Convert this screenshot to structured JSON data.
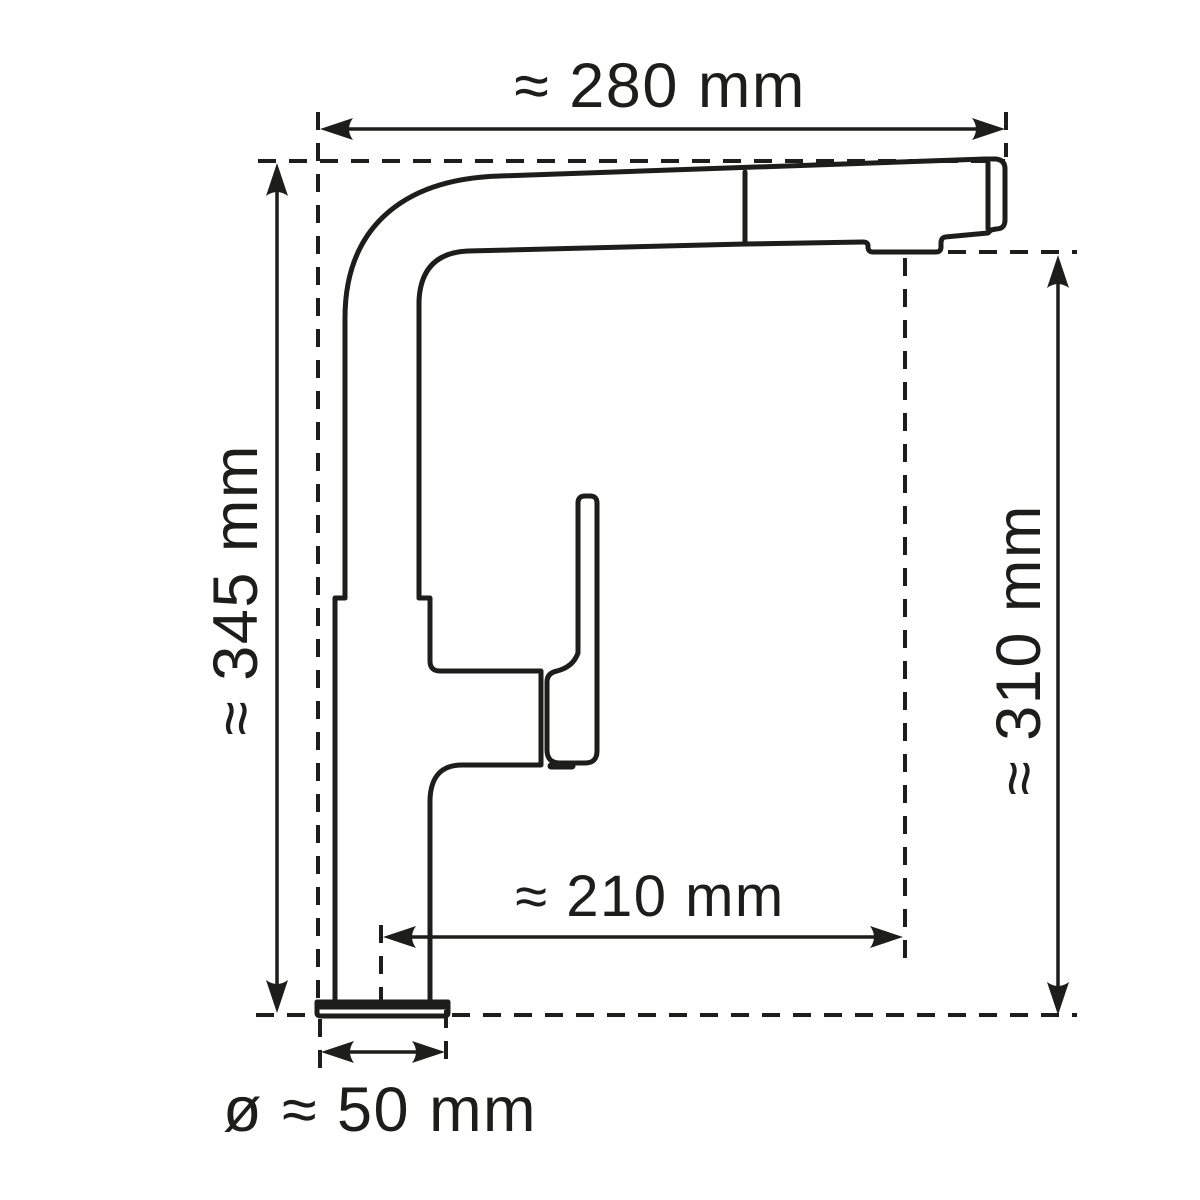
{
  "diagram": {
    "subject": "Kitchen mixer tap with pull-out spray head, side view technical line drawing with dimension annotations",
    "units": "mm",
    "style": {
      "line_color": "#1d1d1b",
      "background_color": "#ffffff"
    },
    "dimensions": {
      "overall_width": {
        "label": "≈ 280 mm",
        "value_mm": 280,
        "approximate": true,
        "orientation": "horizontal",
        "position": "top"
      },
      "overall_height": {
        "label": "≈ 345 mm",
        "value_mm": 345,
        "approximate": true,
        "orientation": "vertical",
        "position": "left"
      },
      "spout_height": {
        "label": "≈ 310 mm",
        "value_mm": 310,
        "approximate": true,
        "orientation": "vertical",
        "position": "right"
      },
      "spout_reach": {
        "label": "≈ 210 mm",
        "value_mm": 210,
        "approximate": true,
        "orientation": "horizontal",
        "position": "bottom-middle"
      },
      "base_diameter": {
        "label": "ø ≈ 50 mm",
        "value_mm": 50,
        "approximate": true,
        "orientation": "horizontal",
        "position": "bottom"
      }
    }
  }
}
